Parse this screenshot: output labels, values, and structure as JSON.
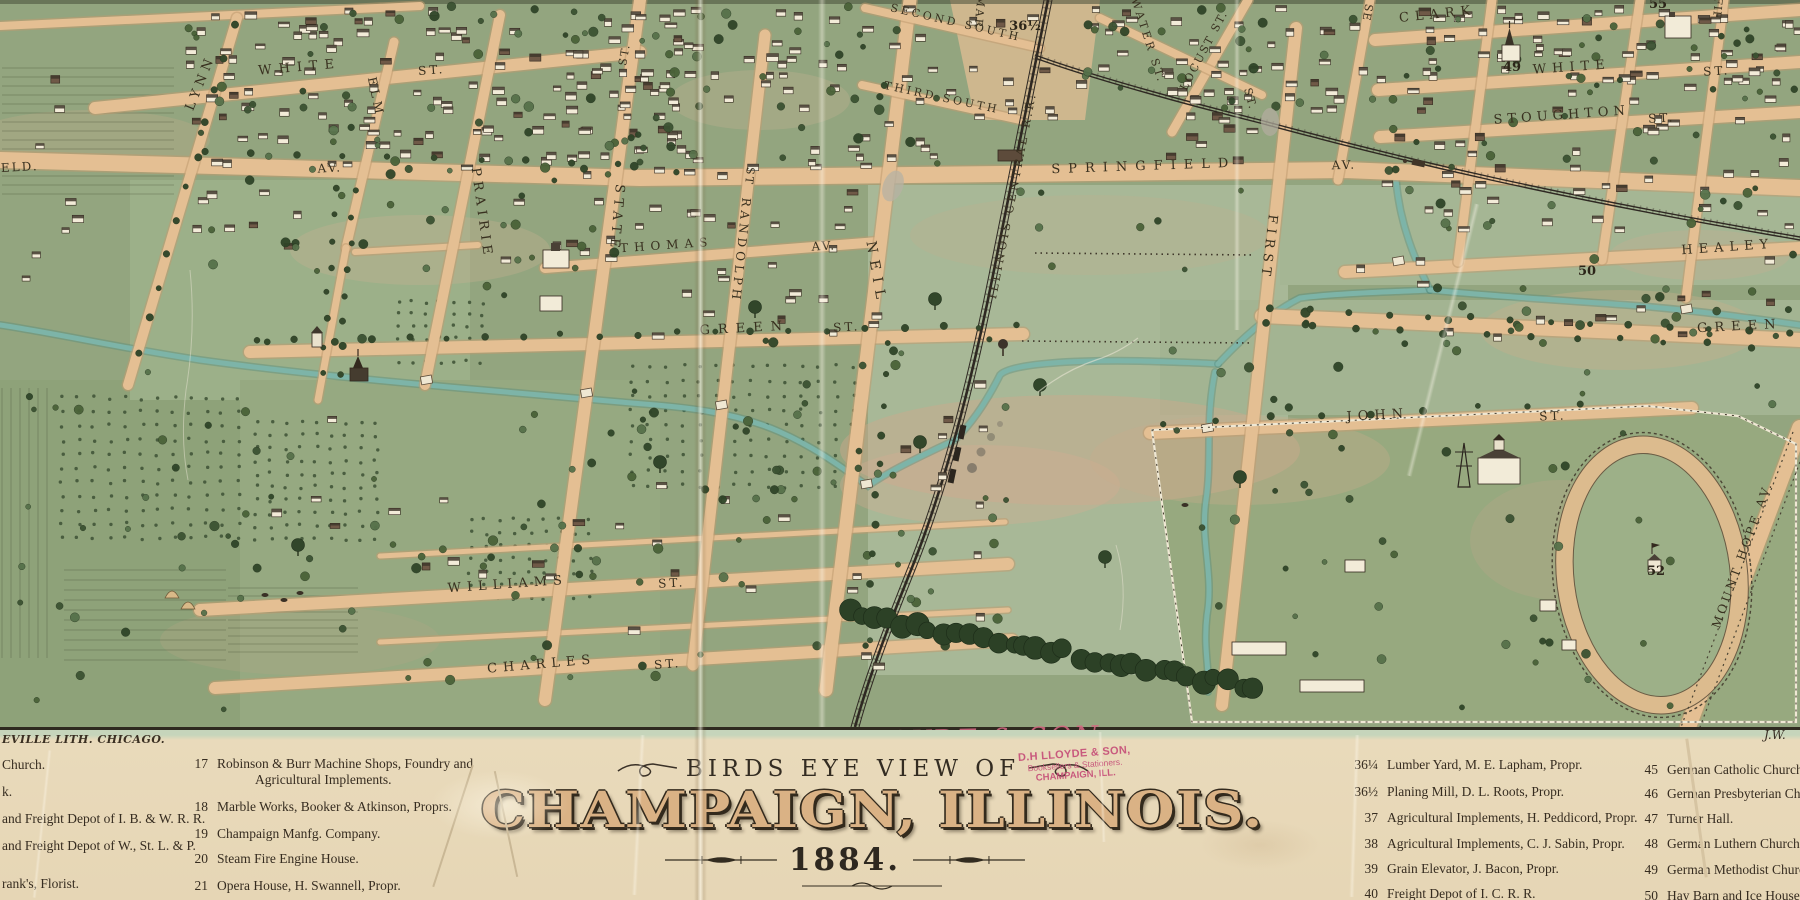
{
  "colors": {
    "paper_margin": "#e8d9ba",
    "road_tan": "#e2bd92",
    "block_green": "#93a57f",
    "field_light": "#a8b897",
    "creek": "#7db4a8",
    "rail_dark": "#2e2822",
    "title_fill": "#dab285",
    "title_outline": "#332a1d",
    "overprint_pink": "#d36681",
    "stamp_pink": "#c64f78",
    "label_ink": "#38301f",
    "green_band": "#c6d5bb"
  },
  "map": {
    "street_labels": [
      {
        "t": "WHITE",
        "x": 300,
        "y": 71,
        "r": -5,
        "s": 13,
        "ls": 7
      },
      {
        "t": "ST.",
        "x": 432,
        "y": 74,
        "r": -4,
        "s": 12,
        "ls": 3
      },
      {
        "t": "LYNN",
        "x": 204,
        "y": 84,
        "r": -68,
        "s": 13,
        "ls": 5
      },
      {
        "t": "ELM",
        "x": 372,
        "y": 98,
        "r": 78,
        "s": 12,
        "ls": 4
      },
      {
        "t": "AV.",
        "x": 330,
        "y": 172,
        "r": -3,
        "s": 12,
        "ls": 2
      },
      {
        "t": "ELD.",
        "x": 20,
        "y": 171,
        "r": -3,
        "s": 12,
        "ls": 2
      },
      {
        "t": "PRAIRIE",
        "x": 478,
        "y": 214,
        "r": 82,
        "s": 13,
        "ls": 5
      },
      {
        "t": "STATE",
        "x": 613,
        "y": 218,
        "r": 95,
        "s": 13,
        "ls": 5
      },
      {
        "t": "ST.",
        "x": 628,
        "y": 55,
        "r": -80,
        "s": 11,
        "ls": 2
      },
      {
        "t": "THOMAS",
        "x": 667,
        "y": 249,
        "r": -4,
        "s": 12,
        "ls": 6
      },
      {
        "t": "AV.",
        "x": 824,
        "y": 250,
        "r": -3,
        "s": 12,
        "ls": 2
      },
      {
        "t": "ST",
        "x": 746,
        "y": 176,
        "r": 96,
        "s": 11,
        "ls": 2
      },
      {
        "t": "RANDOLPH",
        "x": 737,
        "y": 250,
        "r": 96,
        "s": 12,
        "ls": 4
      },
      {
        "t": "NEIL",
        "x": 872,
        "y": 274,
        "r": 80,
        "s": 14,
        "ls": 7
      },
      {
        "t": "GREEN",
        "x": 745,
        "y": 332,
        "r": -3,
        "s": 13,
        "ls": 8
      },
      {
        "t": "ST.",
        "x": 847,
        "y": 331,
        "r": -3,
        "s": 12,
        "ls": 3
      },
      {
        "t": "WILLIAMS",
        "x": 508,
        "y": 588,
        "r": -4,
        "s": 13,
        "ls": 6
      },
      {
        "t": "ST.",
        "x": 672,
        "y": 587,
        "r": -3,
        "s": 12,
        "ls": 3
      },
      {
        "t": "CHARLES",
        "x": 542,
        "y": 668,
        "r": -5,
        "s": 13,
        "ls": 6
      },
      {
        "t": "ST.",
        "x": 668,
        "y": 668,
        "r": -4,
        "s": 12,
        "ls": 3
      },
      {
        "t": "SECOND SOUTH",
        "x": 955,
        "y": 26,
        "r": 13,
        "s": 11,
        "ls": 3
      },
      {
        "t": "THIRD SOUTH",
        "x": 941,
        "y": 101,
        "r": 12,
        "s": 11,
        "ls": 3
      },
      {
        "t": "MAR",
        "x": 976,
        "y": 12,
        "r": 95,
        "s": 11,
        "ls": 2
      },
      {
        "t": "WATER ST.",
        "x": 1145,
        "y": 42,
        "r": 72,
        "s": 11,
        "ls": 3
      },
      {
        "t": "ST.",
        "x": 1247,
        "y": 100,
        "r": 75,
        "s": 11,
        "ls": 2
      },
      {
        "t": "ILLINOIS CENTRAL R.R.",
        "x": 1016,
        "y": 196,
        "r": -79,
        "s": 11.5,
        "ls": 3
      },
      {
        "t": "SPRINGFIELD",
        "x": 1144,
        "y": 170,
        "r": -2,
        "s": 13,
        "ls": 8
      },
      {
        "t": "AV.",
        "x": 1344,
        "y": 169,
        "r": -2,
        "s": 12,
        "ls": 2
      },
      {
        "t": "FIRST",
        "x": 1265,
        "y": 247,
        "r": 97,
        "s": 13,
        "ls": 5
      },
      {
        "t": "LOCUST ST.",
        "x": 1207,
        "y": 52,
        "r": -62,
        "s": 11,
        "ls": 2
      },
      {
        "t": "SE",
        "x": 1364,
        "y": 12,
        "r": 100,
        "s": 11,
        "ls": 1
      },
      {
        "t": "CLARK",
        "x": 1438,
        "y": 18,
        "r": -6,
        "s": 13,
        "ls": 6
      },
      {
        "t": "WHITE",
        "x": 1572,
        "y": 71,
        "r": -4,
        "s": 13,
        "ls": 6
      },
      {
        "t": "ST.",
        "x": 1717,
        "y": 75,
        "r": -3,
        "s": 12,
        "ls": 3
      },
      {
        "t": "FIF",
        "x": 1714,
        "y": 8,
        "r": 95,
        "s": 11,
        "ls": 1
      },
      {
        "t": "STOUGHTON",
        "x": 1562,
        "y": 119,
        "r": -4,
        "s": 13,
        "ls": 5
      },
      {
        "t": "ST.",
        "x": 1662,
        "y": 122,
        "r": -3,
        "s": 12,
        "ls": 3
      },
      {
        "t": "HEALEY",
        "x": 1728,
        "y": 251,
        "r": -4,
        "s": 13,
        "ls": 6
      },
      {
        "t": "GREEN",
        "x": 1740,
        "y": 330,
        "r": -3,
        "s": 13,
        "ls": 7
      },
      {
        "t": "JOHN",
        "x": 1378,
        "y": 419,
        "r": -3,
        "s": 13,
        "ls": 6
      },
      {
        "t": "ST.",
        "x": 1553,
        "y": 420,
        "r": -2,
        "s": 12,
        "ls": 3
      },
      {
        "t": "MOUNT HOPE AV.",
        "x": 1746,
        "y": 556,
        "r": -70,
        "s": 12,
        "ls": 3
      }
    ],
    "number_labels": [
      {
        "t": "36½",
        "x": 1025,
        "y": 30
      },
      {
        "t": "49",
        "x": 1512,
        "y": 71
      },
      {
        "t": "55",
        "x": 1658,
        "y": 8
      },
      {
        "t": "50",
        "x": 1587,
        "y": 275
      },
      {
        "t": "52",
        "x": 1656,
        "y": 575
      }
    ]
  },
  "margin": {
    "lith_credit": "EVILLE LITH. CHICAGO.",
    "artist_fragment": "J.W.",
    "overprint": "D. H. LLOYDE & SON",
    "title_small": "BIRDS EYE VIEW OF",
    "title_main": "CHAMPAIGN, ILLINOIS.",
    "title_year": "1884.",
    "stamp": {
      "line1": "D.H LLOYDE & SON,",
      "line2": "Booksellers & Stationers.",
      "line3": "CHAMPAIGN, ILL."
    },
    "legend_left_fragments": [
      "Church.",
      "k.",
      "and Freight Depot of I. B. & W. R. R.",
      "and Freight Depot of W., St. L. & P.",
      "rank's, Florist."
    ],
    "legend_col1": [
      {
        "num": "17",
        "text": "Robinson & Burr Machine Shops, Foundry and",
        "text2": "Agricultural Implements."
      },
      {
        "num": "18",
        "text": "Marble Works, Booker & Atkinson, Proprs."
      },
      {
        "num": "19",
        "text": "Champaign Manfg. Company."
      },
      {
        "num": "20",
        "text": "Steam Fire Engine House."
      },
      {
        "num": "21",
        "text": "Opera House, H. Swannell, Propr."
      }
    ],
    "legend_col2": [
      {
        "num": "36¼",
        "text": "Lumber Yard, M. E. Lapham, Propr."
      },
      {
        "num": "36½",
        "text": "Planing Mill, D. L. Roots, Propr."
      },
      {
        "num": "37",
        "text": "Agricultural Implements, H. Peddicord, Propr."
      },
      {
        "num": "38",
        "text": "Agricultural Implements, C. J. Sabin, Propr."
      },
      {
        "num": "39",
        "text": "Grain Elevator, J. Bacon, Propr."
      },
      {
        "num": "40",
        "text": "Freight Depot of I. C. R. R."
      }
    ],
    "legend_col3": [
      {
        "num": "45",
        "text": "German Catholic Church."
      },
      {
        "num": "46",
        "text": "German Presbyterian Chu"
      },
      {
        "num": "47",
        "text": "Turner Hall."
      },
      {
        "num": "48",
        "text": "German Luthern Church."
      },
      {
        "num": "49",
        "text": "German Methodist Church"
      },
      {
        "num": "50",
        "text": "Hay Barn and Ice House, C"
      }
    ]
  }
}
